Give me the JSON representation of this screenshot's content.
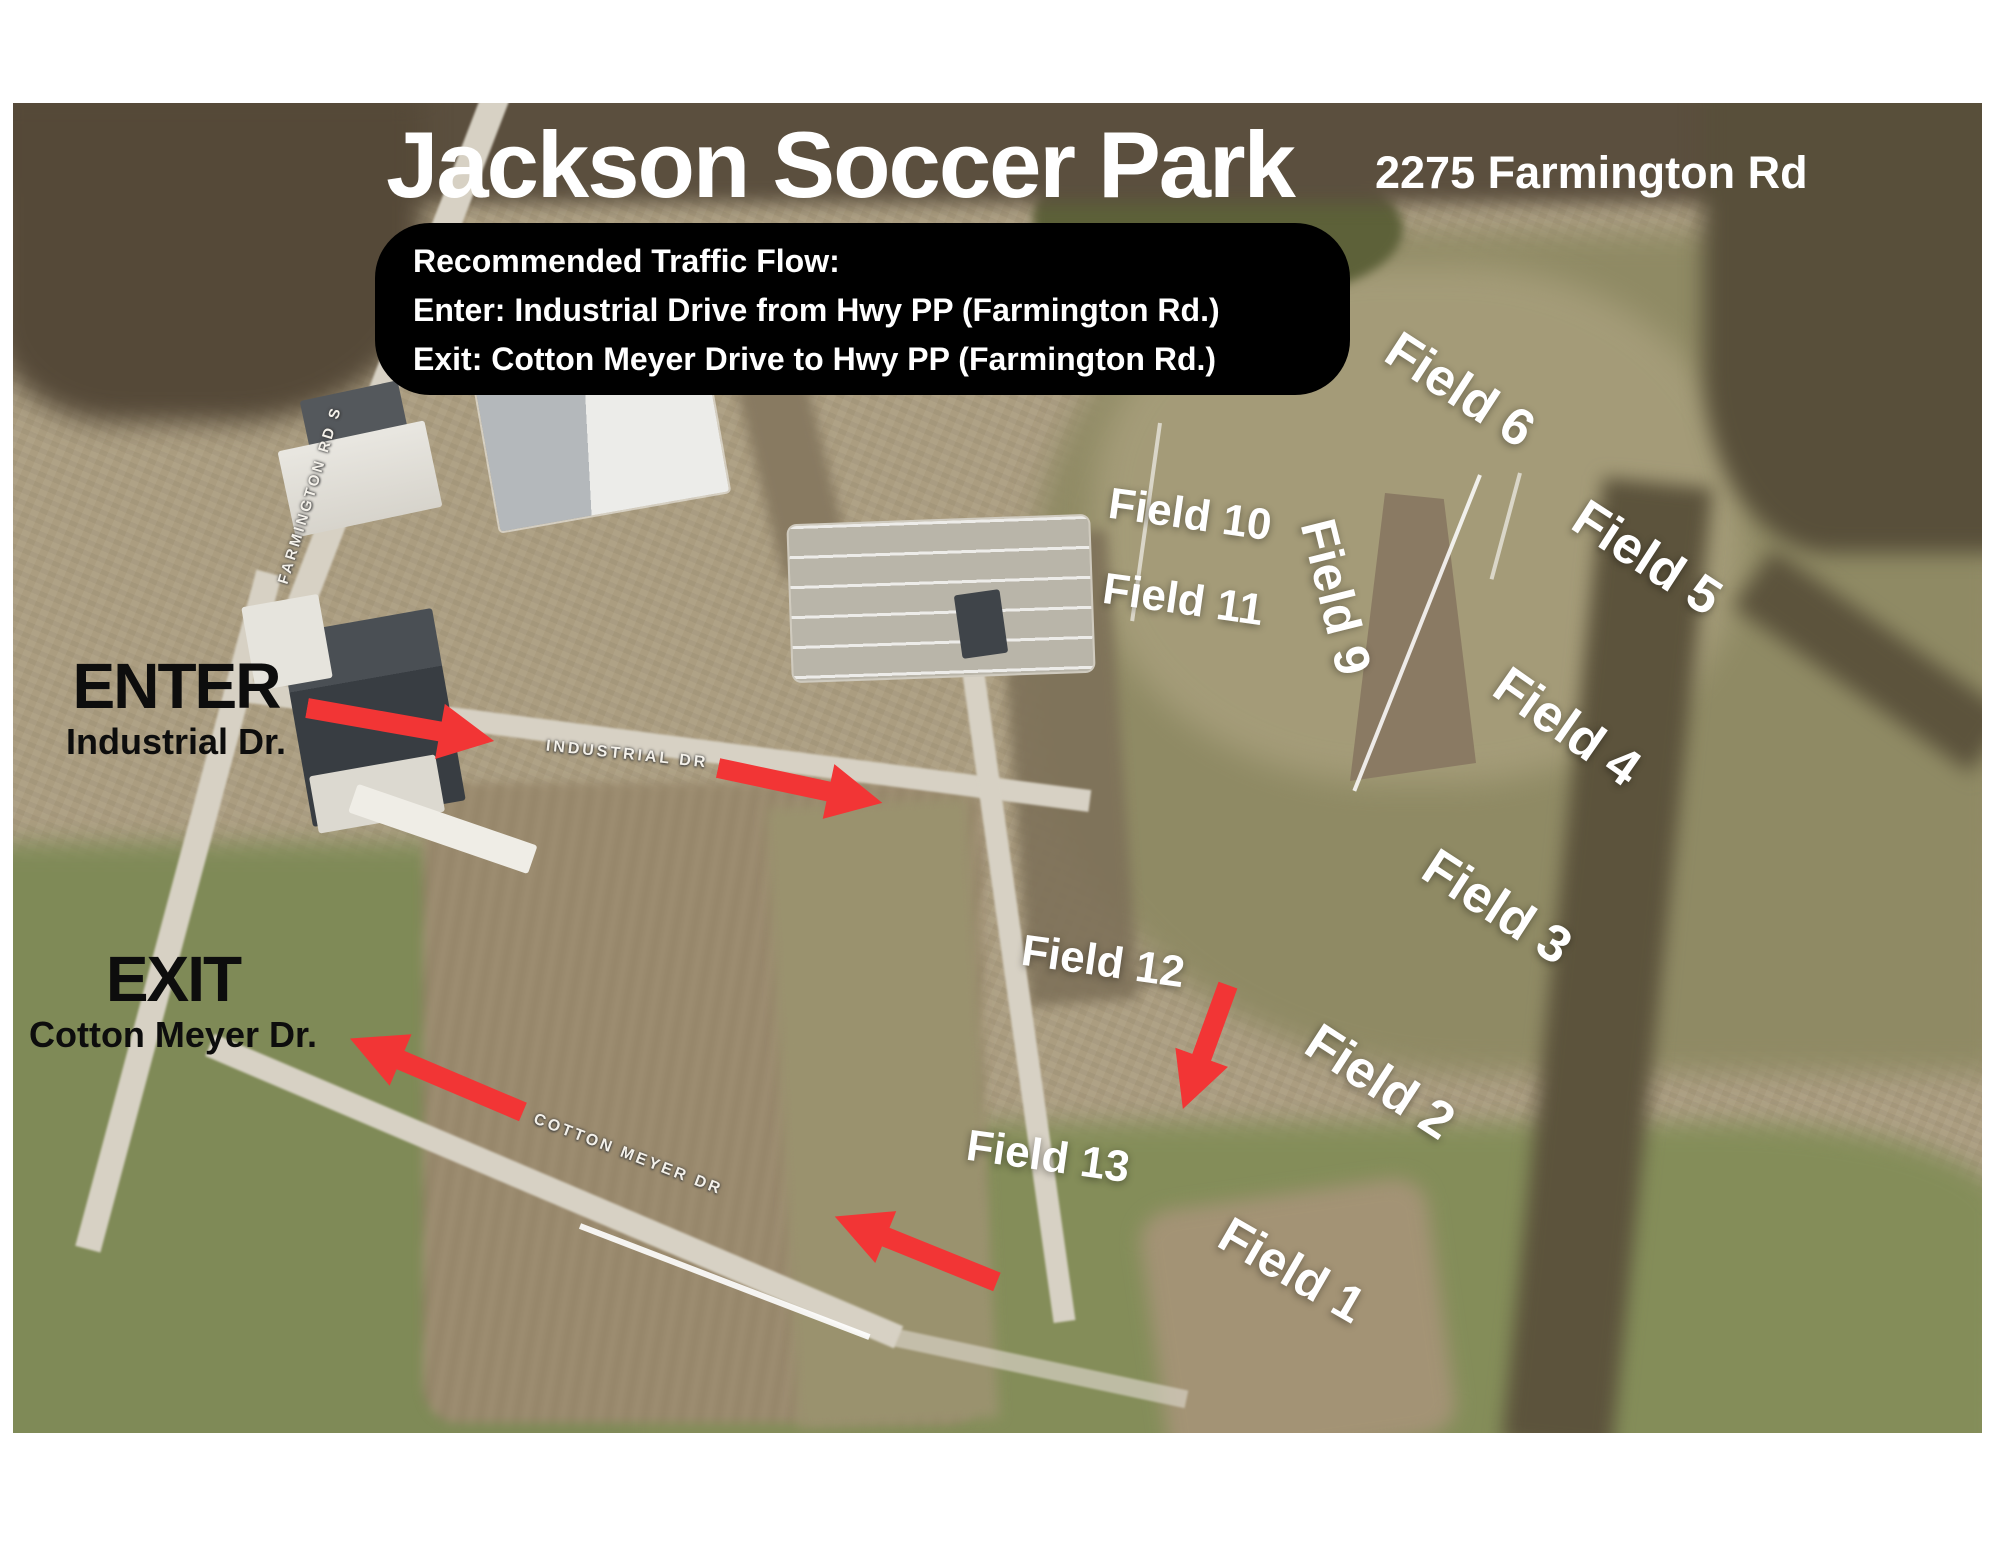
{
  "page": {
    "title": "Jackson Soccer Park",
    "address": "2275 Farmington Rd"
  },
  "traffic_box": {
    "heading": "Recommended Traffic Flow:",
    "enter_line": "Enter: Industrial Drive from Hwy PP (Farmington Rd.)",
    "exit_line": "Exit: Cotton Meyer Drive to Hwy PP (Farmington Rd.)"
  },
  "entrance": {
    "label": "ENTER",
    "street": "Industrial Dr."
  },
  "exit": {
    "label": "EXIT",
    "street": "Cotton Meyer Dr."
  },
  "fields": {
    "f1": {
      "label": "Field 1"
    },
    "f2": {
      "label": "Field 2"
    },
    "f3": {
      "label": "Field 3"
    },
    "f4": {
      "label": "Field 4"
    },
    "f5": {
      "label": "Field 5"
    },
    "f6": {
      "label": "Field 6"
    },
    "f9": {
      "label": "Field 9"
    },
    "f10": {
      "label": "Field 10"
    },
    "f11": {
      "label": "Field 11"
    },
    "f12": {
      "label": "Field 12"
    },
    "f13": {
      "label": "Field 13"
    }
  },
  "roads": {
    "farmington": "FARMINGTON RD S",
    "industrial": "INDUSTRIAL DR",
    "cotton_meyer": "COTTON MEYER DR"
  },
  "colors": {
    "arrow_red": "#f23535",
    "overlay_black": "#000000",
    "label_white": "#ffffff"
  }
}
